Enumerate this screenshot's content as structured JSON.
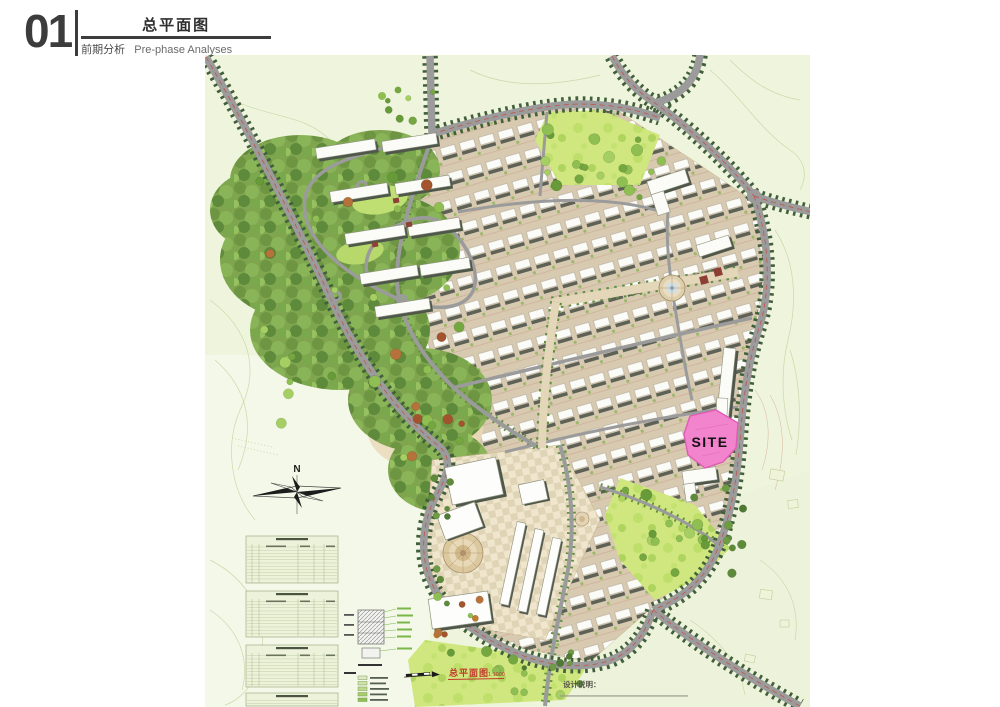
{
  "header": {
    "number": "01",
    "title_cn": "总平面图",
    "subtitle_cn": "前期分析",
    "subtitle_en": "Pre-phase Analyses"
  },
  "map": {
    "site_label": "SITE",
    "compass_label": "N",
    "plan_caption": "总平面图",
    "plan_scale": "1:1000",
    "notes_title": "设计说明：",
    "colors": {
      "map_background": "#eff4dc",
      "road_gray": "#9b9b9b",
      "street_tree_green": "#415f3a",
      "forest_green": "#7fa64f",
      "lawn_green": "#cfe77e",
      "site_pink": "#f283cd",
      "caption_red": "#c03a2b"
    },
    "indicator_tables": {
      "blocks": 4
    },
    "legend_rows": 5
  }
}
